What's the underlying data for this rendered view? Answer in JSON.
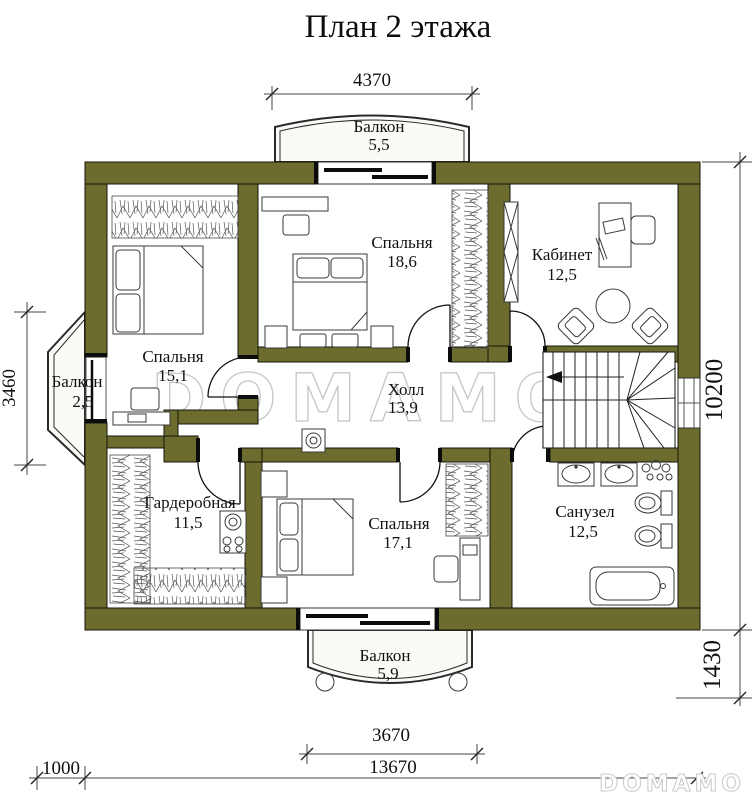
{
  "title": "План 2 этажа",
  "watermark": {
    "center": "DOMAMO",
    "corner": "DOMAMO"
  },
  "colors": {
    "wall": "#6c6c2e",
    "lines": "#111111",
    "watermark": "#c6c6c6"
  },
  "rooms": {
    "balcony_top": {
      "name": "Балкон",
      "area": "5,5"
    },
    "bedroom_top": {
      "name": "Спальня",
      "area": "18,6"
    },
    "study": {
      "name": "Кабинет",
      "area": "12,5"
    },
    "bedroom_left": {
      "name": "Спальня",
      "area": "15,1"
    },
    "balcony_left": {
      "name": "Балкон",
      "area": "2,5"
    },
    "hall": {
      "name": "Холл",
      "area": "13,9"
    },
    "wardrobe": {
      "name": "Гардеробная",
      "area": "11,5"
    },
    "bedroom_bottom": {
      "name": "Спальня",
      "area": "17,1"
    },
    "bathroom": {
      "name": "Санузел",
      "area": "12,5"
    },
    "balcony_bottom": {
      "name": "Балкон",
      "area": "5,9"
    }
  },
  "dimensions": {
    "top": "4370",
    "left": "3460",
    "right": "10200",
    "right_lower": "1430",
    "balcony_bottom": "3670",
    "bottom_total": "13670",
    "bottom_left_offset": "1000"
  }
}
